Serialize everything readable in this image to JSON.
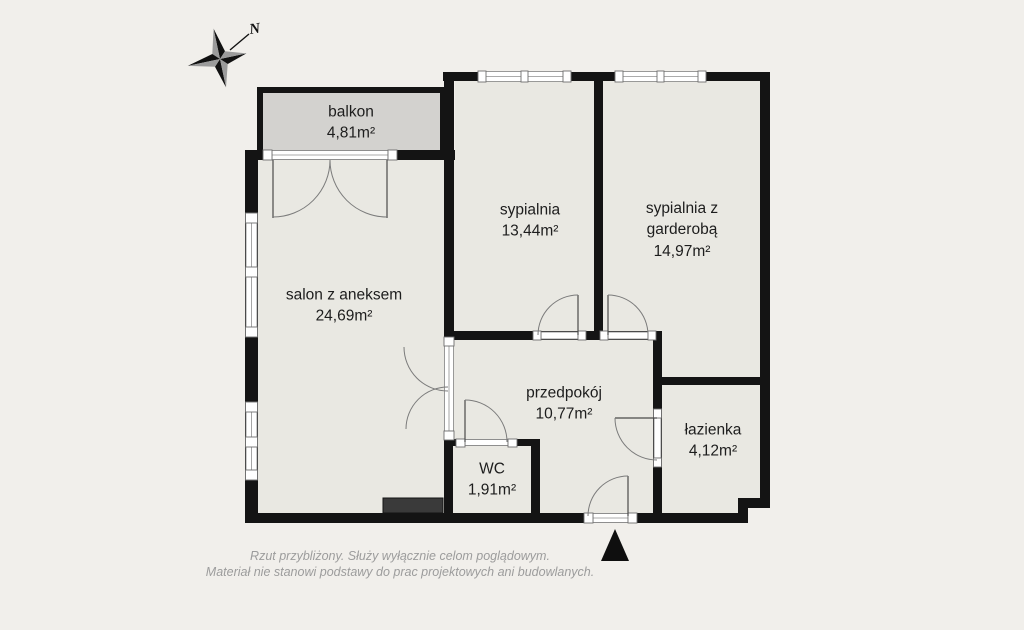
{
  "plan": {
    "compass": {
      "north_label": "N"
    },
    "rooms": {
      "balkon": {
        "name": "balkon",
        "area": "4,81m²"
      },
      "sypialnia": {
        "name": "sypialnia",
        "area": "13,44m²"
      },
      "sypialnia_garderoba": {
        "name": "sypialnia z garderobą",
        "area": "14,97m²"
      },
      "salon": {
        "name": "salon z aneksem",
        "area": "24,69m²"
      },
      "przedpokoj": {
        "name": "przedpokój",
        "area": "10,77m²"
      },
      "wc": {
        "name": "WC",
        "area": "1,91m²"
      },
      "lazienka": {
        "name": "łazienka",
        "area": "4,12m²"
      }
    },
    "disclaimer": {
      "line1": "Rzut przybliżony. Służy wyłącznie celom poglądowym.",
      "line2": "Materiał nie stanowi podstawy do prac projektowych ani budowlanych."
    },
    "colors": {
      "background": "#f1efeb",
      "room_fill": "#e9e8e2",
      "balcony_fill": "#d3d2cf",
      "wall": "#141414",
      "window_stroke": "#8f8f8f",
      "door_arc": "#7b7b7b",
      "dark_block": "#3a3a3a",
      "label_text": "#1d1d1d",
      "disclaimer_text": "#9c9c9c",
      "compass_gray": "#9b9b9b"
    }
  }
}
